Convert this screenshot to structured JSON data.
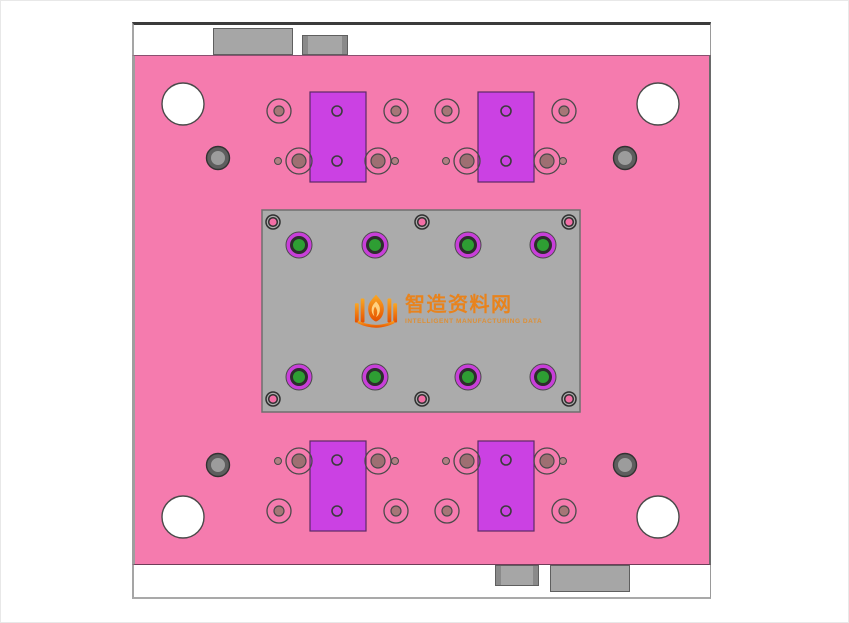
{
  "drawing": {
    "title": "mold-base-plate-top-view",
    "watermark": {
      "title": "智造资料网",
      "subtitle": "INTELLIGENT MANUFACTURING DATA"
    }
  },
  "colors": {
    "page_bg": "#FFFFFF",
    "rail_white": "#FFFFFF",
    "plate_pink": "#F57BAE",
    "tab_gray": "#A6A6A6",
    "tab_dark": "#8A8A8A",
    "core_gray": "#ABABAB",
    "insert_purple": "#CB41E3",
    "ejector_magenta": "#C83FD9",
    "ejector_green": "#2E9E33",
    "hole_brown": "#9E6F72",
    "dot_brown": "#B08083",
    "screw_pink": "#F36FA6",
    "wm_orange": "#E8831D",
    "wm_orange_light": "#DE8F35"
  },
  "features": {
    "core_plate": {
      "x": 261,
      "y": 209,
      "w": 318,
      "h": 202,
      "fill": "core_gray",
      "stroke": "#6F6F6F"
    },
    "inserts": {
      "w": 56,
      "h": 90,
      "fill": "insert_purple",
      "stroke": "#5C2A66",
      "positions": [
        [
          309,
          91
        ],
        [
          477,
          91
        ],
        [
          309,
          440
        ],
        [
          477,
          440
        ]
      ]
    },
    "circle_groups": [
      {
        "name": "corner-hole",
        "positions": [
          [
            182,
            103
          ],
          [
            657,
            103
          ],
          [
            182,
            516
          ],
          [
            657,
            516
          ]
        ],
        "layers": [
          {
            "r": 21,
            "fill": "#FFFFFF",
            "stroke": "#4A4A4A",
            "sw": 1.4
          }
        ]
      },
      {
        "name": "edge-pin",
        "positions": [
          [
            217,
            157
          ],
          [
            624,
            157
          ],
          [
            217,
            464
          ],
          [
            624,
            464
          ]
        ],
        "layers": [
          {
            "r": 11.5,
            "fill": "#5E5E5E",
            "stroke": "#323232",
            "sw": 1.4
          },
          {
            "r": 7.5,
            "fill": "#9C9C9C",
            "stroke": "#5E5E5E",
            "sw": 1
          }
        ]
      },
      {
        "name": "ring-hole",
        "positions": [
          [
            278,
            110
          ],
          [
            395,
            110
          ],
          [
            446,
            110
          ],
          [
            563,
            110
          ],
          [
            278,
            510
          ],
          [
            395,
            510
          ],
          [
            446,
            510
          ],
          [
            563,
            510
          ]
        ],
        "layers": [
          {
            "r": 12,
            "fill": "none",
            "stroke": "#4A4A4A",
            "sw": 1.3
          },
          {
            "r": 5,
            "fill": "#A67677",
            "stroke": "#4A4A4A",
            "sw": 1.2
          }
        ]
      },
      {
        "name": "guide-bushing",
        "positions": [
          [
            298,
            160
          ],
          [
            377,
            160
          ],
          [
            466,
            160
          ],
          [
            546,
            160
          ],
          [
            298,
            460
          ],
          [
            377,
            460
          ],
          [
            466,
            460
          ],
          [
            546,
            460
          ]
        ],
        "layers": [
          {
            "r": 13,
            "fill": "none",
            "stroke": "#4A4A4A",
            "sw": 1.3
          },
          {
            "r": 7,
            "fill": "hole_brown",
            "stroke": "#4A4A4A",
            "sw": 1.2
          }
        ]
      },
      {
        "name": "small-dot",
        "positions": [
          [
            277,
            160
          ],
          [
            394,
            160
          ],
          [
            445,
            160
          ],
          [
            562,
            160
          ],
          [
            277,
            460
          ],
          [
            394,
            460
          ],
          [
            445,
            460
          ],
          [
            562,
            460
          ]
        ],
        "layers": [
          {
            "r": 3.5,
            "fill": "dot_brown",
            "stroke": "#4A4A4A",
            "sw": 1
          }
        ]
      },
      {
        "name": "insert-hole",
        "positions": [
          [
            336,
            110
          ],
          [
            336,
            160
          ],
          [
            505,
            110
          ],
          [
            505,
            160
          ],
          [
            336,
            459
          ],
          [
            336,
            510
          ],
          [
            505,
            459
          ],
          [
            505,
            510
          ]
        ],
        "layers": [
          {
            "r": 5,
            "fill": "none",
            "stroke": "#3C3C3C",
            "sw": 1.6
          }
        ]
      },
      {
        "name": "plate-screw",
        "positions": [
          [
            272,
            221
          ],
          [
            421,
            221
          ],
          [
            568,
            221
          ],
          [
            272,
            398
          ],
          [
            421,
            398
          ],
          [
            568,
            398
          ]
        ],
        "layers": [
          {
            "r": 7,
            "fill": "none",
            "stroke": "#2F2F2F",
            "sw": 1.5
          },
          {
            "r": 4.3,
            "fill": "screw_pink",
            "stroke": "#2F2F2F",
            "sw": 1.5
          }
        ]
      },
      {
        "name": "ejector-pin",
        "positions": [
          [
            298,
            244
          ],
          [
            374,
            244
          ],
          [
            467,
            244
          ],
          [
            542,
            244
          ],
          [
            298,
            376
          ],
          [
            374,
            376
          ],
          [
            467,
            376
          ],
          [
            542,
            376
          ]
        ],
        "layers": [
          {
            "r": 13,
            "fill": "ejector_magenta",
            "stroke": "#4A4A4A",
            "sw": 1
          },
          {
            "r": 7.5,
            "fill": "ejector_green",
            "stroke": "#2D2D2D",
            "sw": 3
          }
        ]
      }
    ]
  }
}
